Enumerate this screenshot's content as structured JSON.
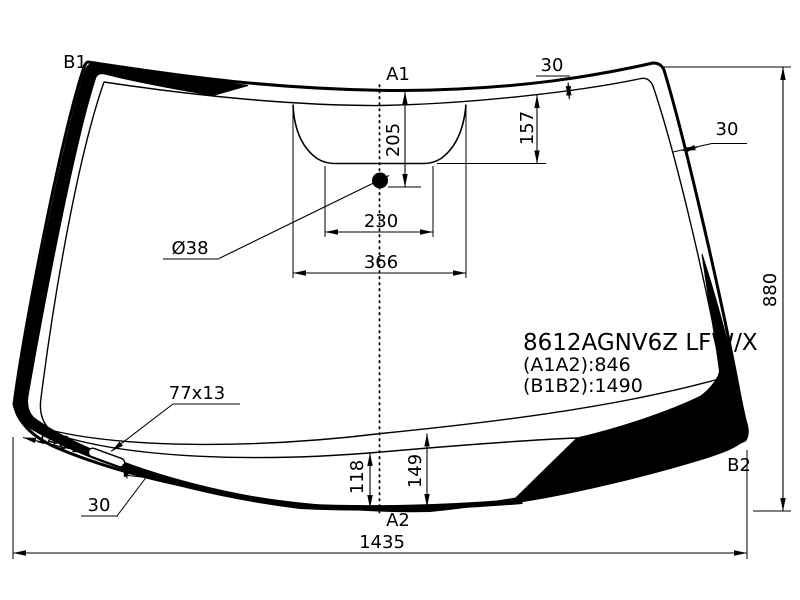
{
  "title_block": {
    "part_number": "8612AGNV6Z LFW/X",
    "a1a2": "(A1A2):846",
    "b1b2": "(B1B2):1490"
  },
  "corner_labels": {
    "b1": "B1",
    "a1": "A1",
    "a2": "A2",
    "b2": "B2"
  },
  "dimensions": {
    "top_band_width": "30",
    "right_band_width": "30",
    "sensor_bracket_depth": "157",
    "sensor_center_from_top": "205",
    "sensor_bracket_bottom_width": "230",
    "sensor_bracket_top_width": "366",
    "sensor_diameter": "Ø38",
    "glass_height": "880",
    "glass_bottom_width": "1435",
    "bottom_band_height_left": "118",
    "bottom_band_height_right": "149",
    "moulding_size": "77x13",
    "moulding_offset_from_corner": "140",
    "moulding_gap_from_edge": "30"
  },
  "colors": {
    "line": "#000000",
    "background": "#ffffff"
  }
}
